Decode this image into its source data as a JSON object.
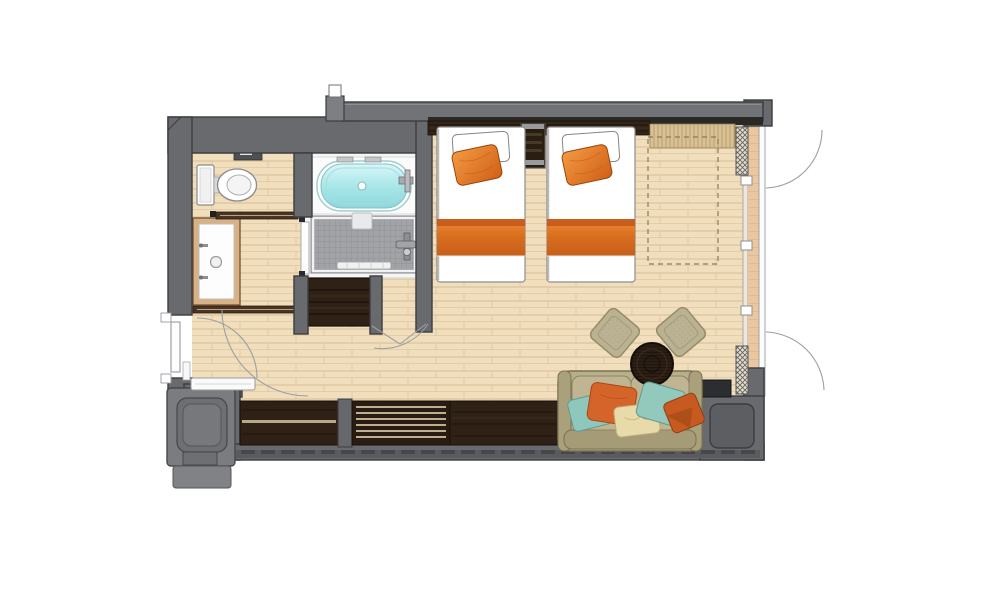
{
  "scene": {
    "kind": "hotel-guest-room-floor-plan",
    "text_labels": []
  },
  "palette": {
    "background": "#ffffff",
    "wall_gray": "#686a6d",
    "wall_light": "#7b7c7f",
    "wall_dark": "#3b3c3f",
    "roof_gray": "#717376",
    "floor_wood": "#f0debc",
    "floor_line": "#cfb286",
    "terrace_wood": "#eac7a0",
    "terrace_line": "#cfa87c",
    "dark_wood": "#2f2116",
    "dark_wood_line": "#171008",
    "tile_gray": "#a2a3a6",
    "tile_line": "#8b8c90",
    "tub_rim": "#9fced1",
    "tub_water": "#9fe0e3",
    "accent_orange": "#e07423",
    "accent_orange_dark": "#b95217",
    "sofa_khaki": "#b9b08e",
    "sofa_dark": "#79714f",
    "pillow_teal": "#90c7bd",
    "pillow_cream": "#e8daa9",
    "bench_bamboo": "#d9c194",
    "arc_line": "#9aa0a4",
    "dash_line": "#8a7a58",
    "fixture_stroke": "#8e8f92"
  },
  "rooms": [
    "entry",
    "toilet-room",
    "vanity-area",
    "bathroom",
    "closet",
    "bedroom-living-area",
    "terrace"
  ],
  "furniture": [
    "toilet",
    "vanity-sink",
    "bathtub",
    "shower",
    "twin-bed-1",
    "twin-bed-2",
    "nightstand",
    "window-bench",
    "sofa",
    "coffee-table",
    "ottoman-1",
    "ottoman-2",
    "tv-block",
    "media-cabinet",
    "luggage-bench",
    "entry-door",
    "terrace-door-arcs",
    "service-duct",
    "dashed-layout-area"
  ]
}
